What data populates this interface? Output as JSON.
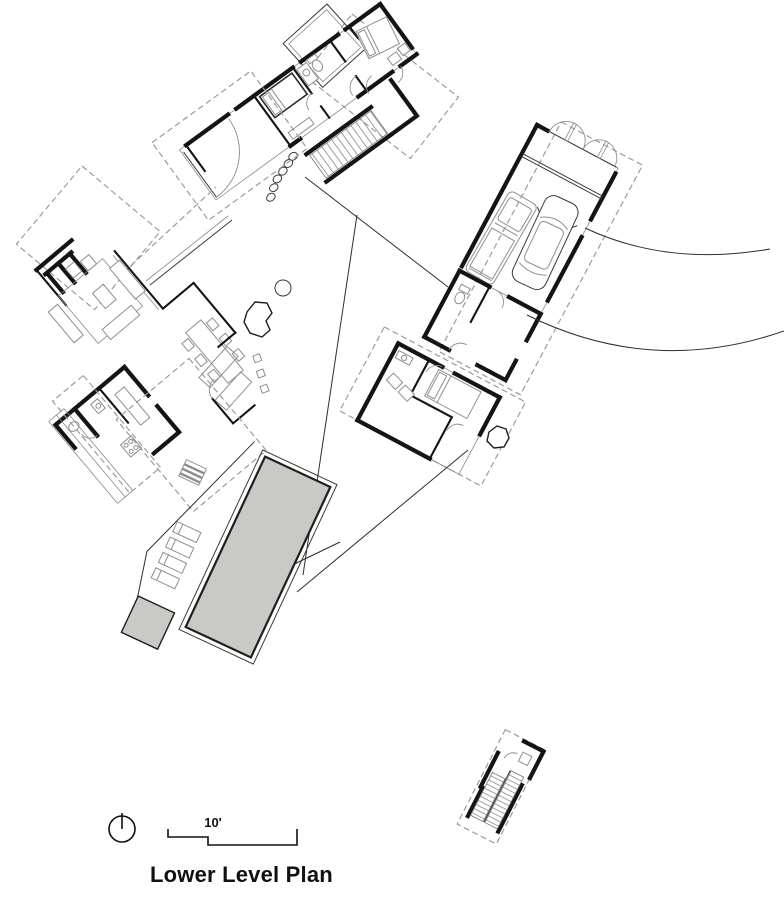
{
  "plan": {
    "title": "Lower Level Plan",
    "scale_label": "10'"
  },
  "legend": {
    "north_arrow": "north-arrow-icon",
    "scale_bar": "scale-bar-icon"
  },
  "features": {
    "wings": [
      "upper-bedroom-wing",
      "garage-wing",
      "guest-bedroom-wing",
      "living-dining-kitchen-wing"
    ],
    "site": [
      "pool",
      "spa",
      "pool-deck-lounge-chairs",
      "driveway",
      "detached-stair-structure",
      "entry-patio",
      "exterior-stair",
      "roof-deck",
      "stepping-stones",
      "tree",
      "boulders"
    ],
    "garage_cars": 2,
    "lounge_chair_count": 4
  },
  "colors": {
    "background": "#ffffff",
    "wall": "#141414",
    "furniture": "#8f8f8f",
    "dashed": "#9c9c9c",
    "hatch": "#a6a6a6",
    "pool_fill": "#c9c9c6",
    "site_line": "#2e2e2e",
    "text": "#111111"
  }
}
